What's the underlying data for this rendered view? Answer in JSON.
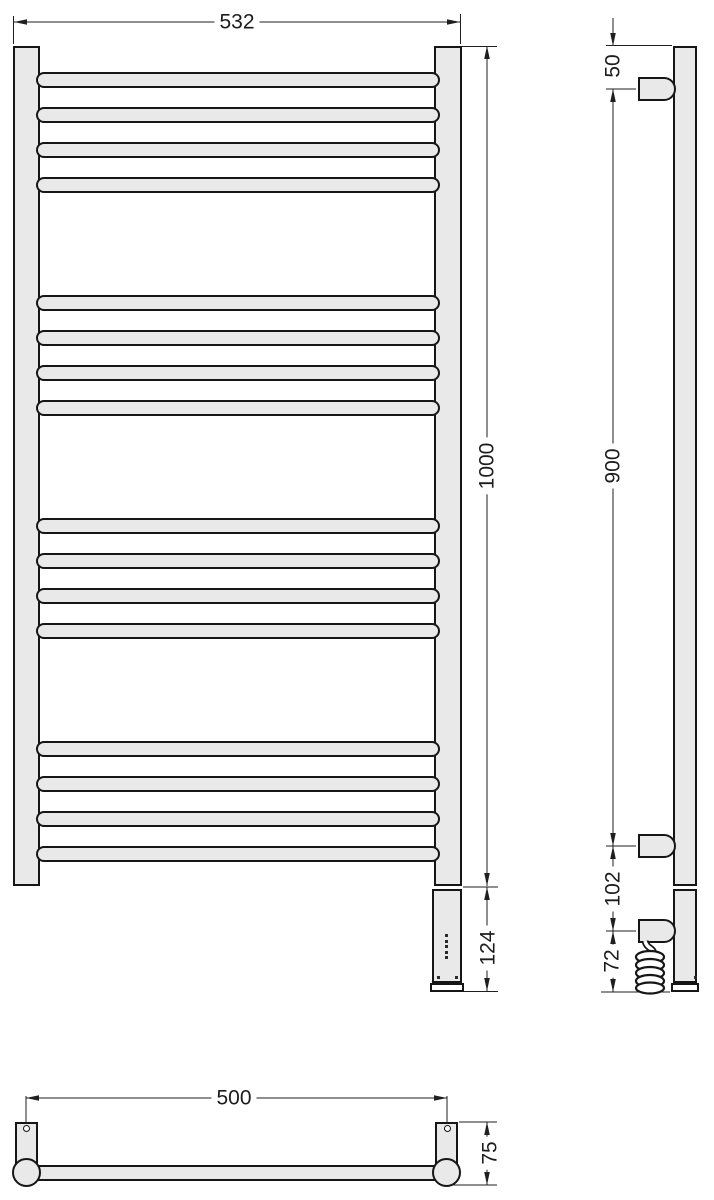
{
  "drawing": {
    "colors": {
      "background": "#ffffff",
      "outline": "#161616",
      "fill": "#e9e9e9",
      "dimension_line": "#1f1f1f"
    },
    "views": {
      "front": {
        "width_dim": "532",
        "height_dim": "1000",
        "heater_dim": "124",
        "bar_groups": 4,
        "bars_per_group": 4,
        "indicator_dots": 5
      },
      "side": {
        "top_offset_dim": "50",
        "bracket_span_dim": "900",
        "lower_bracket_dim": "102",
        "cable_dim": "72"
      },
      "bottom": {
        "width_dim": "500",
        "depth_dim": "75"
      }
    }
  }
}
